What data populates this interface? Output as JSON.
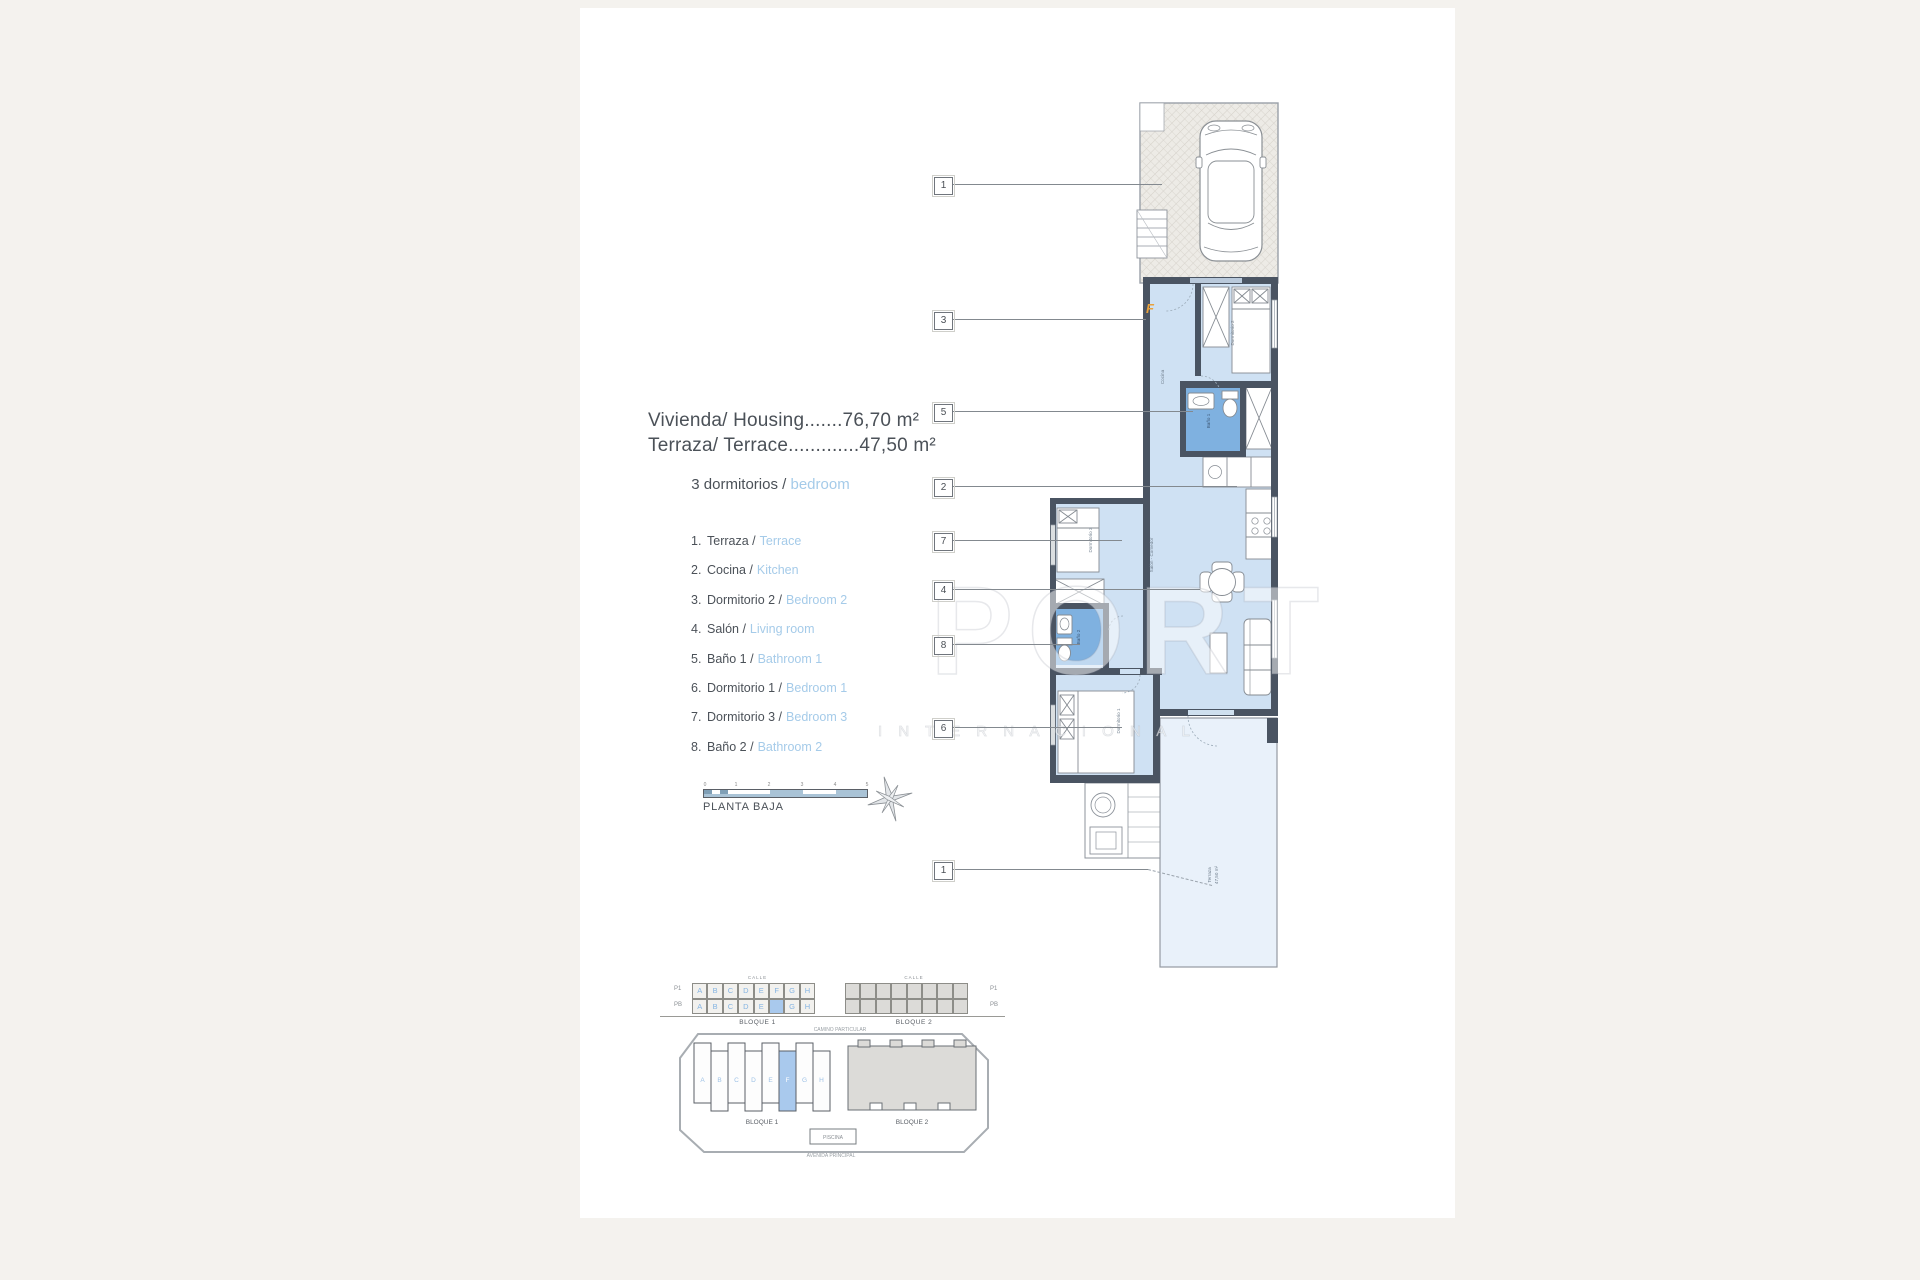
{
  "colors": {
    "background": "#f4f2ee",
    "paper": "#ffffff",
    "wall": "#4a5462",
    "room_fill": "#cfe1f3",
    "bath_fill": "#7fb1e0",
    "terrace_fill": "#e9f1fa",
    "legend_blue": "#a5cbe9",
    "highlight_unit": "#a9c9ed",
    "entrance_orange": "#e8a13c"
  },
  "title_block": {
    "line1": "Vivienda/ Housing.......76,70 m²",
    "line2": "Terraza/ Terrace.............47,50 m²",
    "subtitle_dark": "3 dormitorios /",
    "subtitle_blue": "bedroom"
  },
  "legend": {
    "items": [
      {
        "num": "1.",
        "es": "Terraza /",
        "en": "Terrace"
      },
      {
        "num": "2.",
        "es": "Cocina /",
        "en": "Kitchen"
      },
      {
        "num": "3.",
        "es": "Dormitorio 2 /",
        "en": "Bedroom 2"
      },
      {
        "num": "4.",
        "es": "Salón /",
        "en": "Living room"
      },
      {
        "num": "5.",
        "es": "Baño 1 /",
        "en": "Bathroom 1"
      },
      {
        "num": "6.",
        "es": "Dormitorio 1 /",
        "en": "Bedroom 1"
      },
      {
        "num": "7.",
        "es": "Dormitorio 3 /",
        "en": "Bedroom 3"
      },
      {
        "num": "8.",
        "es": "Baño 2 /",
        "en": "Bathroom 2"
      }
    ]
  },
  "scale_bar": {
    "label": "PLANTA BAJA",
    "ticks": [
      "0",
      "1",
      "2",
      "3",
      "4",
      "5"
    ]
  },
  "callouts": {
    "labels": [
      "1",
      "3",
      "5",
      "2",
      "7",
      "4",
      "8",
      "6",
      "1"
    ]
  },
  "plan": {
    "labels": {
      "entrance": "F",
      "dormitorio2": "Dormitorio 2",
      "bano1": "Baño 1",
      "cocina": "Cocina",
      "salon": "Salón - Comedor",
      "dormitorio3": "Dormitorio 3",
      "bano2": "Baño 2",
      "dormitorio1": "Dormitorio 1",
      "terraza1": "Terraza",
      "terraza2": "47,50 m²"
    }
  },
  "watermark": {
    "big": "PORT",
    "small": "I N T E R N A C I O N A L"
  },
  "elevation": {
    "row_labels": [
      "P1",
      "PB"
    ],
    "street": "CALLE",
    "b1p1": [
      "A",
      "B",
      "C",
      "D",
      "E",
      "F",
      "G",
      "H"
    ],
    "b1pb": [
      "A",
      "B",
      "C",
      "D",
      "E",
      "",
      "G",
      "H"
    ],
    "block1": "BLOQUE 1",
    "block2": "BLOQUE 2",
    "note": "CAMINO PARTICULAR"
  },
  "siteplan": {
    "letters": [
      "A",
      "B",
      "C",
      "D",
      "E",
      "F",
      "G",
      "H"
    ],
    "block1": "BLOQUE 1",
    "block2": "BLOQUE 2",
    "pool": "PISCINA",
    "note": "AVENIDA PRINCIPAL"
  }
}
